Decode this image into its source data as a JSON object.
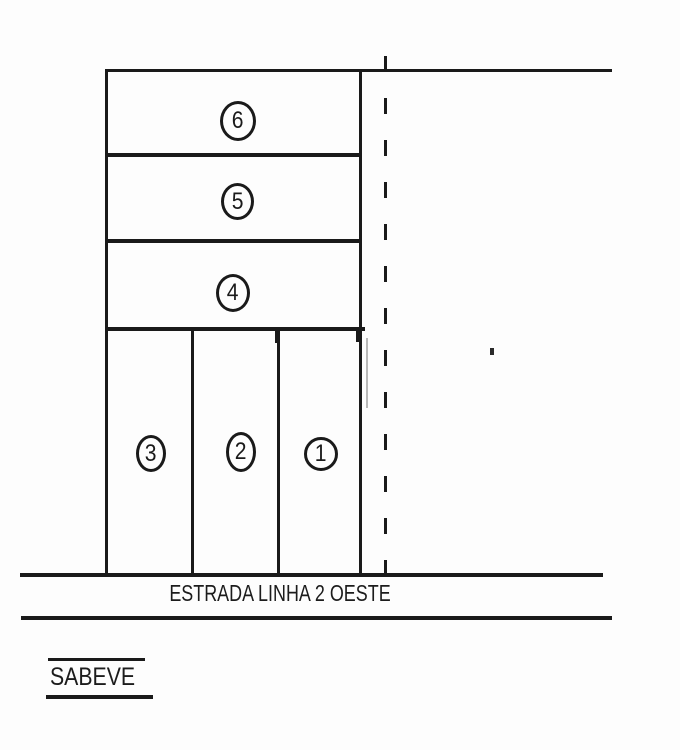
{
  "lots": [
    {
      "number": "6"
    },
    {
      "number": "5"
    },
    {
      "number": "4"
    },
    {
      "number": "3"
    },
    {
      "number": "2"
    },
    {
      "number": "1"
    }
  ],
  "road": {
    "name": "ESTRADA LINHA 2 OESTE"
  },
  "signature": {
    "name": "SABEVE"
  },
  "colors": {
    "line": "#1a1a1a",
    "background": "#fdfdfd",
    "artifact_gray": "#b9b9b9"
  }
}
